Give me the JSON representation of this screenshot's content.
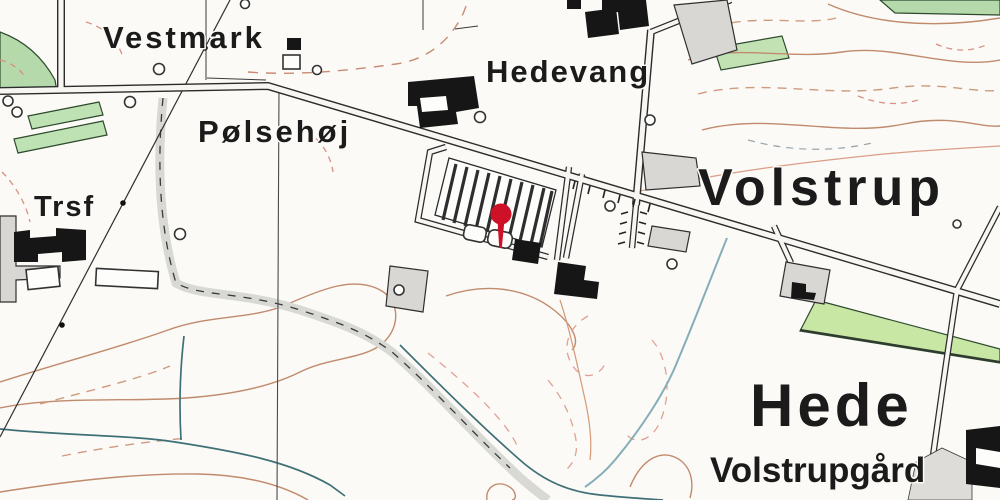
{
  "map": {
    "labels": {
      "vestmark": "Vestmark",
      "hedevang": "Hedevang",
      "polsehoj": "Pølsehøj",
      "trsf": "Trsf",
      "volstrup": "Volstrup",
      "hede": "Hede",
      "volstrupgard": "Volstrupgård"
    },
    "marker": {
      "icon": "location-pin-icon",
      "color": "#ce1126",
      "x": 501,
      "y": 214
    },
    "colors": {
      "pin_red": "#ce1126",
      "contour_brown": "#c18a6c",
      "contour_dashed": "#cf9a7d",
      "stream_teal": "#3f7076",
      "vegetation_green": "#c9e7a4",
      "grove_green": "#b5d9ab",
      "road_fill": "#f7f6f3",
      "road_casing": "#2b2b2b",
      "track_gray": "#d8d8d4",
      "label_ink": "#1b1b1b",
      "background": "#fbfaf7"
    }
  }
}
